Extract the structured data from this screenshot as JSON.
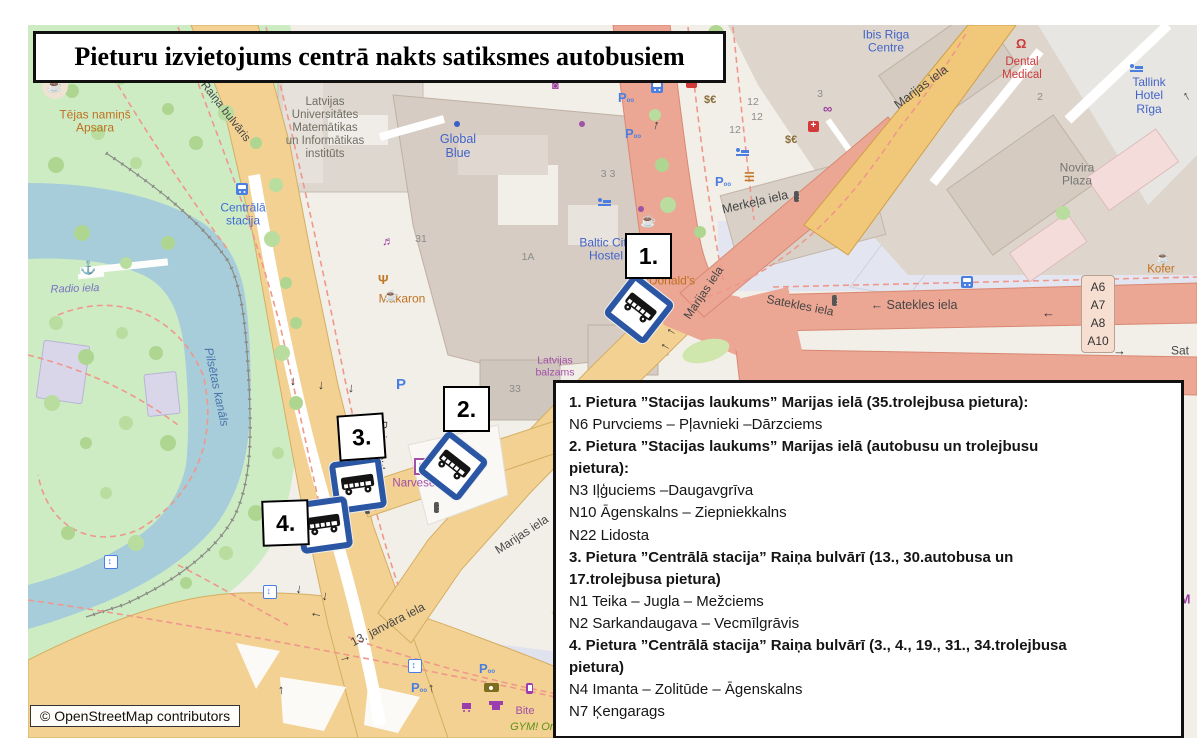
{
  "title": {
    "text": "Pieturu izvietojums centrā nakts satiksmes autobusiem"
  },
  "copyright": {
    "text": "© OpenStreetMap contributors"
  },
  "legend": {
    "items": [
      {
        "bold": true,
        "text": "1. Pietura ”Stacijas laukums” Marijas ielā (35.trolejbusa pietura):"
      },
      {
        "bold": false,
        "text": "N6 Purvciems – Pļavnieki –Dārzciems"
      },
      {
        "bold": true,
        "text": "2.  Pietura ”Stacijas laukums” Marijas ielā (autobusu un trolejbusu\npietura):"
      },
      {
        "bold": false,
        "text": "N3 Iļģuciems –Daugavgrīva"
      },
      {
        "bold": false,
        "text": "N10 Āgenskalns – Ziepniekkalns"
      },
      {
        "bold": false,
        "text": "N22 Lidosta"
      },
      {
        "bold": true,
        "text": "3.  Pietura ”Centrālā stacija” Raiņa bulvārī (13., 30.autobusa un\n17.trolejbusa pietura)"
      },
      {
        "bold": false,
        "text": "N1 Teika – Jugla – Mežciems"
      },
      {
        "bold": false,
        "text": "N2 Sarkandaugava  –  Vecmīlgrāvis"
      },
      {
        "bold": true,
        "text": "4. Pietura ”Centrālā stacija” Raiņa bulvārī (3., 4., 19., 31., 34.trolejbusa\npietura)"
      },
      {
        "bold": false,
        "text": "N4 Imanta  – Zolitūde  – Āgenskalns"
      },
      {
        "bold": false,
        "text": "N7 Ķengarags"
      }
    ]
  },
  "markers": [
    {
      "label": "1.",
      "box": {
        "x": 597,
        "y": 208,
        "rot": 0
      },
      "bus": {
        "x": 585,
        "y": 258,
        "rot": 38
      }
    },
    {
      "label": "2.",
      "box": {
        "x": 415,
        "y": 361,
        "rot": 0
      },
      "bus": {
        "x": 399,
        "y": 415,
        "rot": 38
      }
    },
    {
      "label": "3.",
      "box": {
        "x": 310,
        "y": 389,
        "rot": -4
      },
      "bus": {
        "x": 304,
        "y": 434,
        "rot": -8
      }
    },
    {
      "label": "4.",
      "box": {
        "x": 234,
        "y": 475,
        "rot": -2
      },
      "bus": {
        "x": 270,
        "y": 474,
        "rot": -8
      }
    }
  ],
  "shield": {
    "routes": [
      "A6",
      "A7",
      "A8",
      "A10"
    ]
  },
  "colors": {
    "marker_blue": "#2a56a4",
    "road_tan": "#f2d192",
    "road_salmon": "#eba694",
    "road_yellow": "#f1c879",
    "park": "#cdecc4",
    "water": "#a7cdda",
    "building": "#d9d0c9",
    "poi_orange": "#bf701f",
    "poi_blue": "#4263c8",
    "poi_purple": "#a24fa8"
  },
  "map_labels": [
    {
      "id": "tejas-namins",
      "text": "Tējas namiņš\nApsara",
      "x": 67,
      "y": 97,
      "color": "#bf701f",
      "size": 12
    },
    {
      "id": "radio-iela",
      "text": "Radio iela",
      "x": 47,
      "y": 264,
      "color": "#7a72c0",
      "size": 11,
      "rot": -2,
      "italic": true
    },
    {
      "id": "pilsetas-kanals",
      "text": "Pilsētas kanāls",
      "x": 188,
      "y": 362,
      "color": "#4a74a8",
      "size": 12,
      "rot": 78,
      "italic": true
    },
    {
      "id": "centrala-stacija",
      "text": "Centrālā\nstacija",
      "x": 215,
      "y": 190,
      "color": "#3f6cd6",
      "size": 12
    },
    {
      "id": "universitate",
      "text": "Latvijas\nUniversitātes\nMatemātikas\nun Informātikas\ninstitūts",
      "x": 297,
      "y": 103,
      "color": "#6f6f63",
      "size": 11.5
    },
    {
      "id": "global-blue",
      "text": "Global\nBlue",
      "x": 430,
      "y": 121,
      "color": "#4263c8",
      "size": 12.5
    },
    {
      "id": "makaron",
      "text": "Makaron",
      "x": 374,
      "y": 274,
      "color": "#bf701f",
      "size": 12
    },
    {
      "id": "baltic-hostel",
      "text": "Baltic City\nHostel",
      "x": 578,
      "y": 225,
      "color": "#4263c8",
      "size": 12
    },
    {
      "id": "mcdonalds",
      "text": "McDonald's",
      "x": 636,
      "y": 256,
      "color": "#bf701f",
      "size": 12
    },
    {
      "id": "latvijas-balzams",
      "text": "Latvijas\nbalzams",
      "x": 527,
      "y": 342,
      "color": "#a24fa8",
      "size": 10.5
    },
    {
      "id": "narvesen",
      "text": "Narvesen",
      "x": 389,
      "y": 459,
      "color": "#a24fa8",
      "size": 11.5
    },
    {
      "id": "merkela-iela",
      "text": "Merkeļa iela",
      "x": 727,
      "y": 177,
      "color": "#454545",
      "size": 12.5,
      "rot": -13
    },
    {
      "id": "marijas-iela-top",
      "text": "Marijas iela",
      "x": 893,
      "y": 62,
      "color": "#454545",
      "size": 12.5,
      "rot": -37
    },
    {
      "id": "marijas-iela-mid",
      "text": "Marijas iela",
      "x": 676,
      "y": 268,
      "color": "#454545",
      "size": 12,
      "rot": -56
    },
    {
      "id": "marijas-iela-low",
      "text": "Marijas iela",
      "x": 494,
      "y": 510,
      "color": "#454545",
      "size": 12,
      "rot": -33
    },
    {
      "id": "satekles-diag",
      "text": "Satekles iela",
      "x": 772,
      "y": 281,
      "color": "#454545",
      "size": 12,
      "rot": 11
    },
    {
      "id": "satekles-horiz",
      "text": "← Satekles iela",
      "x": 886,
      "y": 280,
      "color": "#454545",
      "size": 12.5
    },
    {
      "id": "satekles-right",
      "text": "Sat",
      "x": 1152,
      "y": 326,
      "color": "#454545",
      "size": 12
    },
    {
      "id": "kofer",
      "text": "Kofer",
      "x": 1133,
      "y": 245,
      "color": "#bf701f",
      "size": 11.5
    },
    {
      "id": "ibis-riga",
      "text": "Ibis Riga\nCentre",
      "x": 858,
      "y": 17,
      "color": "#4263c8",
      "size": 12
    },
    {
      "id": "dental-medical",
      "text": "Dental\nMedical",
      "x": 994,
      "y": 44,
      "color": "#cc3b3b",
      "size": 11.5
    },
    {
      "id": "tallink",
      "text": "Tallink\nHotel Rīga",
      "x": 1121,
      "y": 71,
      "color": "#4263c8",
      "size": 12
    },
    {
      "id": "novira-plaza",
      "text": "Novira\nPlaza",
      "x": 1049,
      "y": 150,
      "color": "#757575",
      "size": 12
    },
    {
      "id": "bite",
      "text": "Bite",
      "x": 497,
      "y": 686,
      "color": "#a24fa8",
      "size": 11
    },
    {
      "id": "gym",
      "text": "GYM! Ori",
      "x": 505,
      "y": 702,
      "color": "#5a9216",
      "size": 11,
      "italic": true
    },
    {
      "id": "janvara-iela",
      "text": "13. janvāra iela",
      "x": 360,
      "y": 600,
      "color": "#454545",
      "size": 12,
      "rot": -27
    },
    {
      "id": "raina-bulvaris-top",
      "text": "Raiņa bulvāris",
      "x": 197,
      "y": 87,
      "color": "#454545",
      "size": 11.5,
      "rot": 52
    },
    {
      "id": "raina-bulvaris-mid",
      "text": "Raiņa bulvāris",
      "x": 352,
      "y": 432,
      "color": "#454545",
      "size": 11.5,
      "rot": 93
    },
    {
      "id": "metro-m",
      "text": "M",
      "x": 1157,
      "y": 575,
      "color": "#9a3d9e",
      "size": 13,
      "bold": true
    },
    {
      "id": "hn-31",
      "text": "31",
      "x": 393,
      "y": 215,
      "color": "#8c8c8c",
      "size": 10.5
    },
    {
      "id": "hn-1a",
      "text": "1A",
      "x": 500,
      "y": 233,
      "color": "#8c8c8c",
      "size": 10.5
    },
    {
      "id": "hn-33",
      "text": "3 3",
      "x": 580,
      "y": 150,
      "color": "#8c8c8c",
      "size": 10.5
    },
    {
      "id": "hn-33b",
      "text": "33",
      "x": 487,
      "y": 365,
      "color": "#8c8c8c",
      "size": 10.5
    },
    {
      "id": "hn-10",
      "text": "10",
      "x": 689,
      "y": 34,
      "color": "#8c8c8c",
      "size": 10.5
    },
    {
      "id": "hn-12a",
      "text": "12",
      "x": 725,
      "y": 78,
      "color": "#8c8c8c",
      "size": 10.5
    },
    {
      "id": "hn-12b",
      "text": "12",
      "x": 729,
      "y": 93,
      "color": "#8c8c8c",
      "size": 10.5
    },
    {
      "id": "hn-12c",
      "text": "12",
      "x": 707,
      "y": 106,
      "color": "#8c8c8c",
      "size": 10.5
    },
    {
      "id": "hn-3",
      "text": "3",
      "x": 792,
      "y": 70,
      "color": "#8c8c8c",
      "size": 10.5
    },
    {
      "id": "hn-2",
      "text": "2",
      "x": 1012,
      "y": 73,
      "color": "#8c8c8c",
      "size": 10.5
    }
  ],
  "icons": [
    {
      "kind": "cafe",
      "cls": "poi-circle",
      "x": 14,
      "y": 48,
      "glyph": "☕"
    },
    {
      "kind": "anchor",
      "x": 52,
      "y": 236,
      "glyph": "⚓",
      "color": "#8a7fc7",
      "size": 13
    },
    {
      "kind": "bus-stop",
      "cls": "bus-sm",
      "x": 208,
      "y": 158
    },
    {
      "kind": "bus-stop",
      "cls": "bus-sm",
      "x": 623,
      "y": 56
    },
    {
      "kind": "bus-stop",
      "cls": "bus-sm",
      "x": 933,
      "y": 251
    },
    {
      "kind": "parking-bike",
      "cls": "p-bike",
      "x": 590,
      "y": 66,
      "glyph": "P"
    },
    {
      "kind": "parking-bike",
      "cls": "p-bike",
      "x": 597,
      "y": 102,
      "glyph": "P"
    },
    {
      "kind": "parking-bike",
      "cls": "p-bike",
      "x": 687,
      "y": 150,
      "glyph": "P"
    },
    {
      "kind": "parking-bike",
      "cls": "p-bike",
      "x": 383,
      "y": 656,
      "glyph": "P"
    },
    {
      "kind": "parking-bike",
      "cls": "p-bike",
      "x": 451,
      "y": 637,
      "glyph": "P"
    },
    {
      "kind": "parking",
      "cls": "p-big",
      "x": 368,
      "y": 352,
      "glyph": "P",
      "size": 15
    },
    {
      "kind": "elevator",
      "cls": "elev",
      "x": 235,
      "y": 560
    },
    {
      "kind": "elevator",
      "cls": "elev",
      "x": 380,
      "y": 634
    },
    {
      "kind": "elevator",
      "cls": "elev",
      "x": 76,
      "y": 530
    },
    {
      "kind": "hospital",
      "cls": "hosp",
      "x": 658,
      "y": 52
    },
    {
      "kind": "pharmacy",
      "cls": "hosp",
      "x": 780,
      "y": 96
    },
    {
      "kind": "currency-exchange",
      "x": 676,
      "y": 70,
      "glyph": "$€",
      "color": "#8a6d3b",
      "size": 11,
      "bold": true
    },
    {
      "kind": "currency-exchange",
      "x": 757,
      "y": 110,
      "glyph": "$€",
      "color": "#8a6d3b",
      "size": 11,
      "bold": true
    },
    {
      "kind": "optician",
      "x": 795,
      "y": 77,
      "glyph": "∞",
      "color": "#9a3d9e",
      "size": 13,
      "bold": true
    },
    {
      "kind": "bed",
      "cls": "bed",
      "x": 570,
      "y": 172
    },
    {
      "kind": "bed",
      "cls": "bed",
      "x": 1102,
      "y": 38
    },
    {
      "kind": "bed",
      "cls": "bed",
      "x": 708,
      "y": 122
    },
    {
      "kind": "fastfood",
      "x": 716,
      "y": 146,
      "glyph": "☰",
      "color": "#c07926",
      "size": 12,
      "bold": true
    },
    {
      "kind": "traffic-light",
      "cls": "tl",
      "x": 766,
      "y": 166
    },
    {
      "kind": "traffic-light",
      "cls": "tl",
      "x": 804,
      "y": 270
    },
    {
      "kind": "traffic-light",
      "cls": "tl",
      "x": 406,
      "y": 477
    },
    {
      "kind": "traffic-light",
      "cls": "tl",
      "x": 337,
      "y": 478
    },
    {
      "kind": "shop-bag",
      "x": 524,
      "y": 56,
      "glyph": "◙",
      "color": "#9a3d9e",
      "size": 11
    },
    {
      "kind": "poi-dot",
      "cls": "dotp",
      "x": 551,
      "y": 96
    },
    {
      "kind": "poi-dot",
      "cls": "dotp",
      "x": 610,
      "y": 181
    },
    {
      "kind": "poi-dot",
      "cls": "dotb",
      "x": 426,
      "y": 96
    },
    {
      "kind": "cafe-cup",
      "x": 612,
      "y": 189,
      "glyph": "☕",
      "color": "#c07926",
      "size": 13
    },
    {
      "kind": "cafe-cup",
      "x": 1128,
      "y": 228,
      "glyph": "☕",
      "color": "#c07926",
      "size": 11
    },
    {
      "kind": "restaurant",
      "x": 350,
      "y": 248,
      "glyph": "Ψ",
      "color": "#c07926",
      "size": 13,
      "bold": true
    },
    {
      "kind": "cafe-cup",
      "x": 356,
      "y": 266,
      "glyph": "☕",
      "color": "#c07926",
      "size": 11
    },
    {
      "kind": "music-venue",
      "x": 354,
      "y": 210,
      "glyph": "♬",
      "color": "#9a3d9e",
      "size": 12
    },
    {
      "kind": "kiosk",
      "cls": "narv-kiosk",
      "x": 386,
      "y": 433,
      "glyph": "▤"
    },
    {
      "kind": "optician-shop",
      "cls": "eye",
      "x": 456,
      "y": 658
    },
    {
      "kind": "clothes-shop",
      "cls": "tshirt",
      "x": 464,
      "y": 676
    },
    {
      "kind": "supermarket",
      "cls": "cart",
      "x": 434,
      "y": 678
    },
    {
      "kind": "phone-shop",
      "cls": "phone",
      "x": 498,
      "y": 658
    },
    {
      "kind": "dentist",
      "x": 988,
      "y": 12,
      "glyph": "Ω",
      "color": "#cc3b3b",
      "size": 13,
      "bold": true
    }
  ],
  "arrows": [
    {
      "g": "↓",
      "x": 262,
      "y": 348,
      "r": 5
    },
    {
      "g": "↓",
      "x": 290,
      "y": 352,
      "r": 5
    },
    {
      "g": "↓",
      "x": 320,
      "y": 355,
      "r": 5
    },
    {
      "g": "↑",
      "x": 625,
      "y": 92,
      "r": 15
    },
    {
      "g": "←",
      "x": 638,
      "y": 297,
      "r": 30
    },
    {
      "g": "←",
      "x": 632,
      "y": 312,
      "r": 30
    },
    {
      "g": "↓",
      "x": 268,
      "y": 556,
      "r": 10
    },
    {
      "g": "↓",
      "x": 294,
      "y": 563,
      "r": 10
    },
    {
      "g": "←",
      "x": 282,
      "y": 580,
      "r": 10
    },
    {
      "g": "→",
      "x": 310,
      "y": 624,
      "r": -15
    },
    {
      "g": "↑",
      "x": 400,
      "y": 655,
      "r": -10
    },
    {
      "g": "↑",
      "x": 250,
      "y": 657,
      "r": -8
    },
    {
      "g": "←",
      "x": 1014,
      "y": 280,
      "r": 0
    },
    {
      "g": "→",
      "x": 1085,
      "y": 318,
      "r": 0
    },
    {
      "g": "↑",
      "x": 1155,
      "y": 63,
      "r": -30
    }
  ],
  "trees": [
    [
      14,
      40
    ],
    [
      44,
      66
    ],
    [
      92,
      52
    ],
    [
      140,
      84
    ],
    [
      70,
      108
    ],
    [
      28,
      140
    ],
    [
      108,
      138
    ],
    [
      168,
      118
    ],
    [
      198,
      88
    ],
    [
      228,
      118
    ],
    [
      248,
      160
    ],
    [
      54,
      208
    ],
    [
      98,
      238
    ],
    [
      140,
      218
    ],
    [
      244,
      214
    ],
    [
      258,
      258
    ],
    [
      28,
      298
    ],
    [
      58,
      332
    ],
    [
      94,
      308
    ],
    [
      128,
      328
    ],
    [
      24,
      378
    ],
    [
      58,
      418
    ],
    [
      98,
      398
    ],
    [
      140,
      418
    ],
    [
      78,
      468
    ],
    [
      40,
      508
    ],
    [
      108,
      518
    ],
    [
      158,
      558
    ],
    [
      198,
      528
    ],
    [
      228,
      488
    ],
    [
      250,
      428
    ],
    [
      268,
      378
    ],
    [
      254,
      328
    ],
    [
      268,
      298
    ],
    [
      222,
      18
    ],
    [
      250,
      38
    ],
    [
      627,
      90
    ],
    [
      634,
      140
    ],
    [
      640,
      180
    ],
    [
      672,
      207
    ],
    [
      1035,
      188
    ],
    [
      688,
      8
    ]
  ]
}
